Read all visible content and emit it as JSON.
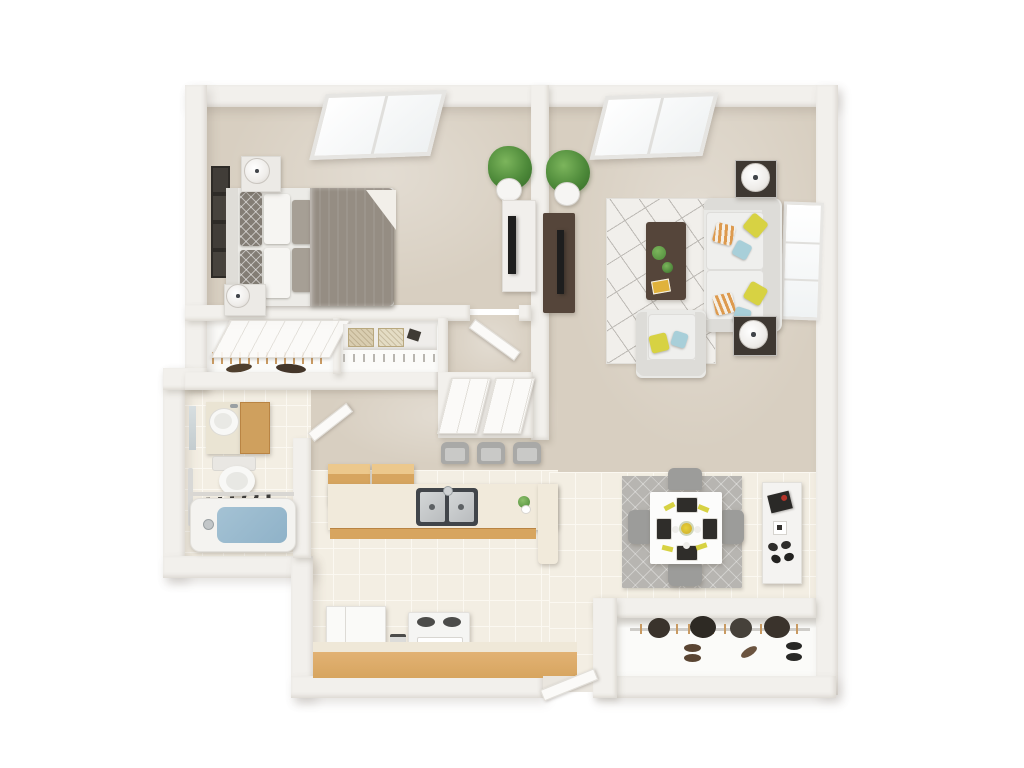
{
  "title": "3D floor plan — one-bedroom apartment",
  "view": "top-down 3D render, no text labels",
  "colors": {
    "wall": "#f2f0ec",
    "carpet": "#d8cfc1",
    "tile": "#f3eee3",
    "grout": "#fbf8f1",
    "closetfloor": "#fbfbf9",
    "woodlight": "#d7a55f",
    "woodtop": "#efe8d8",
    "wooddark": "#55453a",
    "sofa": "#e9e9e6",
    "sofaedge": "#dddcd8",
    "cushion": "#efefed",
    "duvet": "#958d83",
    "pillowwhite": "#f6f5f2",
    "pillowgray": "#a69f95",
    "accentgray": "#837d75",
    "yellow": "#d7d243",
    "blue": "#a8cfd9",
    "orange": "#dd9a4e",
    "ruglight": "#f1efeb",
    "rugline": "#bdbab5",
    "ruggray": "#b7b5b1",
    "chair": "#9c9c9a",
    "stool": "#a9a9a7",
    "lamp": "#efedea",
    "plant": "#4e8a3a",
    "plantdark": "#38702a",
    "pot": "#f6f5f3",
    "water": "#8fb2c8",
    "porcelain": "#f8f8f6",
    "steel": "#b9bcbe",
    "steeldark": "#41454a",
    "tv": "#1e1e1e",
    "shoebrown": "#5a4533",
    "shoeblack": "#282826",
    "coat": "#3a332c",
    "hanger": "#c89a62",
    "basket": "#d9cdb0",
    "basketdark": "#b9a87e",
    "tablewhite": "#fcfcfb",
    "placemat": "#2f2d2a",
    "red": "#b5342a",
    "door": "#fbfaf8",
    "doorline": "#e1ded8"
  },
  "rooms": {
    "bedroom": {
      "name": "Bedroom",
      "floor": "carpet",
      "features": [
        "skylight",
        "double-bed-gray-duvet",
        "nightstand-x2",
        "table-lamp-x2",
        "gallery-frames-x4",
        "potted-plant",
        "dresser-with-tv"
      ]
    },
    "living_room": {
      "name": "Living Room",
      "floor": "carpet",
      "features": [
        "skylight",
        "geometric-area-rug",
        "sofa-with-pillows",
        "armchair",
        "coffee-table",
        "end-table-x2",
        "table-lamp-x2",
        "tv-console",
        "window",
        "potted-plant"
      ]
    },
    "dining_area": {
      "name": "Dining Area",
      "floor": "tile",
      "features": [
        "gray-rug",
        "square-table",
        "placemats-x4",
        "centerpiece",
        "dining-chair-x4",
        "sideboard"
      ]
    },
    "kitchen": {
      "name": "Kitchen",
      "floor": "tile",
      "features": [
        "peninsula-counter",
        "double-sink",
        "bar-stool-x3",
        "wall-cabinets",
        "refrigerator",
        "range",
        "base-cabinets"
      ]
    },
    "bathroom": {
      "name": "Bathroom",
      "floor": "tile",
      "features": [
        "vanity-sink",
        "mirror",
        "toilet",
        "bathtub",
        "towel-rail"
      ]
    },
    "hallway": {
      "name": "Hallway",
      "floor": "carpet",
      "features": [
        "bedroom-door",
        "bathroom-door",
        "hall-closet-doors"
      ]
    },
    "bedroom_closet": {
      "name": "Bedroom Closet",
      "features": [
        "sliding-door",
        "hanging-clothes"
      ]
    },
    "linen_closet": {
      "name": "Linen Closet",
      "features": [
        "shelf",
        "woven-basket-x2",
        "hanging-rod"
      ]
    },
    "entry": {
      "name": "Entry",
      "features": [
        "front-door",
        "threshold"
      ]
    },
    "coat_closet": {
      "name": "Coat Closet",
      "features": [
        "hanging-coats",
        "shoe-pairs-x3"
      ]
    }
  }
}
